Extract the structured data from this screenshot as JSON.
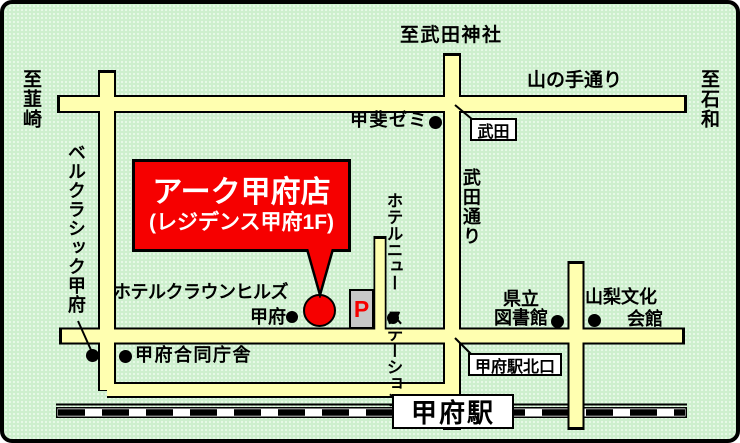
{
  "colors": {
    "background_green": "#cdefcd",
    "road_yellow": "#ffffb0",
    "accent_red": "#f60000",
    "parking_gray": "#c8c8c8",
    "text_black": "#000000"
  },
  "destinations": {
    "north": "至武田神社",
    "west": "至韮崎",
    "east": "至石和"
  },
  "roads": {
    "yamanote": "山の手通り",
    "takeda": "武田通り"
  },
  "store_callout": {
    "name": "アーク甲府店",
    "floor": "(レジデンス甲府1F)"
  },
  "landmarks": {
    "kai_semi": "甲斐ゼミ",
    "takeda_stop": "武田",
    "bel_classic": "ベルクラシック甲府",
    "hotel_new_station": {
      "col1": "ホテルニュー",
      "col2": "ステーション"
    },
    "hotel_crown": {
      "line1": "ホテルクラウンヒルズ",
      "line2": "甲府"
    },
    "parking": "P",
    "pref_library": {
      "line1": "県立",
      "line2": "図書館"
    },
    "yamanashi_bunka": {
      "line1": "山梨文化",
      "line2": "会館"
    },
    "godo_chosha": "甲府合同庁舎"
  },
  "station": {
    "name": "甲府駅",
    "north_exit": "甲府駅北口"
  }
}
